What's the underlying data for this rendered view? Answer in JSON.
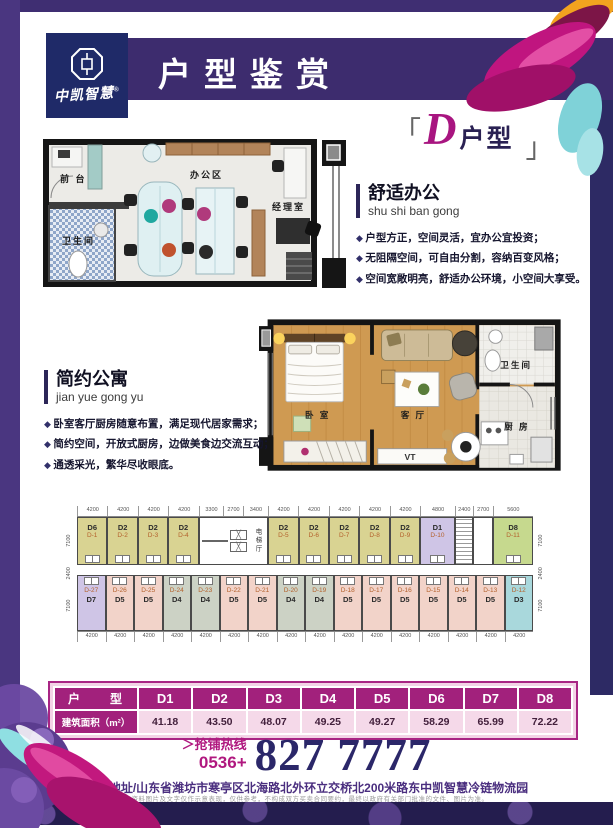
{
  "logo": {
    "name": "中凯智慧",
    "reg": "®"
  },
  "header": {
    "title": "户型鉴赏"
  },
  "unit_tag": {
    "open": "「",
    "letter": "D",
    "suffix": "户型",
    "close": "」"
  },
  "office_plan": {
    "labels": {
      "reception": "前 台",
      "office_area": "办公区",
      "manager": "经理室",
      "bathroom": "卫生间"
    }
  },
  "office_section": {
    "title": "舒适办公",
    "pinyin": "shu shi ban gong",
    "bullets": [
      "户型方正，空间灵活，宜办公宜投资；",
      "无阻隔空间，可自由分割，容纳百变风格；",
      "空间宽敞明亮，舒适办公环境，小空间大享受。"
    ]
  },
  "apartment_section": {
    "title": "简约公寓",
    "pinyin": "jian yue gong yu",
    "bullets": [
      "卧室客厅厨房随意布置，满足现代居家需求；",
      "简约空间，开放式厨房，边做美食边交流互动；",
      "通透采光，繁华尽收眼底。"
    ]
  },
  "apartment_plan": {
    "labels": {
      "bedroom": "卧 室",
      "living": "客 厅",
      "bathroom": "卫生间",
      "kitchen": "厨 房",
      "tv": "VT"
    }
  },
  "floor_plate": {
    "elevator_label": "电梯厅",
    "dims_top": [
      "4200",
      "4200",
      "4200",
      "4200",
      "3300",
      "2700",
      "3400",
      "4200",
      "4200",
      "4200",
      "4200",
      "4200",
      "4800",
      "2400",
      "2700",
      "5600"
    ],
    "dims_bottom": [
      "4200",
      "4200",
      "4200",
      "4200",
      "4200",
      "4200",
      "4200",
      "4200",
      "4200",
      "4200",
      "4200",
      "4200",
      "4200",
      "4200",
      "4200",
      "4200"
    ],
    "dims_left": [
      "7100",
      "2400",
      "7100"
    ],
    "dims_right": [
      "7100",
      "2400",
      "7100"
    ],
    "top_units": [
      {
        "type": "D6",
        "no": "D-1",
        "color": "#d9d392",
        "w": 4.2
      },
      {
        "type": "D2",
        "no": "D-2",
        "color": "#d9d392",
        "w": 4.2
      },
      {
        "type": "D2",
        "no": "D-3",
        "color": "#d9d392",
        "w": 4.2
      },
      {
        "type": "D2",
        "no": "D-4",
        "color": "#d9d392",
        "w": 4.2
      },
      {
        "kind": "core",
        "w": 9.4
      },
      {
        "type": "D2",
        "no": "D-5",
        "color": "#d9d392",
        "w": 4.2
      },
      {
        "type": "D2",
        "no": "D-6",
        "color": "#d9d392",
        "w": 4.2
      },
      {
        "type": "D2",
        "no": "D-7",
        "color": "#d9d392",
        "w": 4.2
      },
      {
        "type": "D2",
        "no": "D-8",
        "color": "#d9d392",
        "w": 4.2
      },
      {
        "type": "D2",
        "no": "D-9",
        "color": "#d9d392",
        "w": 4.2
      },
      {
        "type": "D1",
        "no": "D-10",
        "color": "#cfc5e6",
        "w": 4.8
      },
      {
        "kind": "stair",
        "w": 2.4
      },
      {
        "kind": "svc",
        "w": 2.7
      },
      {
        "type": "D8",
        "no": "D-11",
        "color": "#c6d98e",
        "w": 5.6
      }
    ],
    "bottom_units": [
      {
        "type": "D7",
        "no": "D-27",
        "color": "#cfc5e6",
        "w": 4.2
      },
      {
        "type": "D5",
        "no": "D-26",
        "color": "#f2d3c9",
        "w": 4.2
      },
      {
        "type": "D5",
        "no": "D-25",
        "color": "#f2d3c9",
        "w": 4.2
      },
      {
        "type": "D4",
        "no": "D-24",
        "color": "#ccd2c5",
        "w": 4.2
      },
      {
        "type": "D4",
        "no": "D-23",
        "color": "#ccd2c5",
        "w": 4.2
      },
      {
        "type": "D5",
        "no": "D-22",
        "color": "#f2d3c9",
        "w": 4.2
      },
      {
        "type": "D5",
        "no": "D-21",
        "color": "#f2d3c9",
        "w": 4.2
      },
      {
        "type": "D4",
        "no": "D-20",
        "color": "#ccd2c5",
        "w": 4.2
      },
      {
        "type": "D4",
        "no": "D-19",
        "color": "#ccd2c5",
        "w": 4.2
      },
      {
        "type": "D5",
        "no": "D-18",
        "color": "#f2d3c9",
        "w": 4.2
      },
      {
        "type": "D5",
        "no": "D-17",
        "color": "#f2d3c9",
        "w": 4.2
      },
      {
        "type": "D5",
        "no": "D-16",
        "color": "#f2d3c9",
        "w": 4.2
      },
      {
        "type": "D5",
        "no": "D-15",
        "color": "#f2d3c9",
        "w": 4.2
      },
      {
        "type": "D5",
        "no": "D-14",
        "color": "#f2d3c9",
        "w": 4.2
      },
      {
        "type": "D5",
        "no": "D-13",
        "color": "#f2d3c9",
        "w": 4.2
      },
      {
        "type": "D3",
        "no": "D-12",
        "color": "#a9d8dc",
        "w": 4.2
      }
    ]
  },
  "table": {
    "header": [
      "户　　型",
      "D1",
      "D2",
      "D3",
      "D4",
      "D5",
      "D6",
      "D7",
      "D8"
    ],
    "rows": [
      [
        "建筑面积（m²）",
        "41.18",
        "43.50",
        "48.07",
        "49.25",
        "49.27",
        "58.29",
        "65.99",
        "72.22"
      ]
    ]
  },
  "hotline": {
    "line1": "＞抢铺热线",
    "line2": "0536+",
    "number": "827 7777"
  },
  "address": {
    "text": "项目地址/山东省潍坊市寒亭区北海路北外环立交桥北200米路东",
    "bold": "中凯智慧冷链物流园"
  },
  "disclaimer": "本资料图片及文字仅作示意表现，仅供参考，不构成双方买卖合同要约，最终以政府有关部门批准的文件、图片为准。",
  "colors": {
    "header_purple": "#3d2c6e",
    "accent_magenta": "#a2217c",
    "hotline_navy": "#2b2769"
  }
}
